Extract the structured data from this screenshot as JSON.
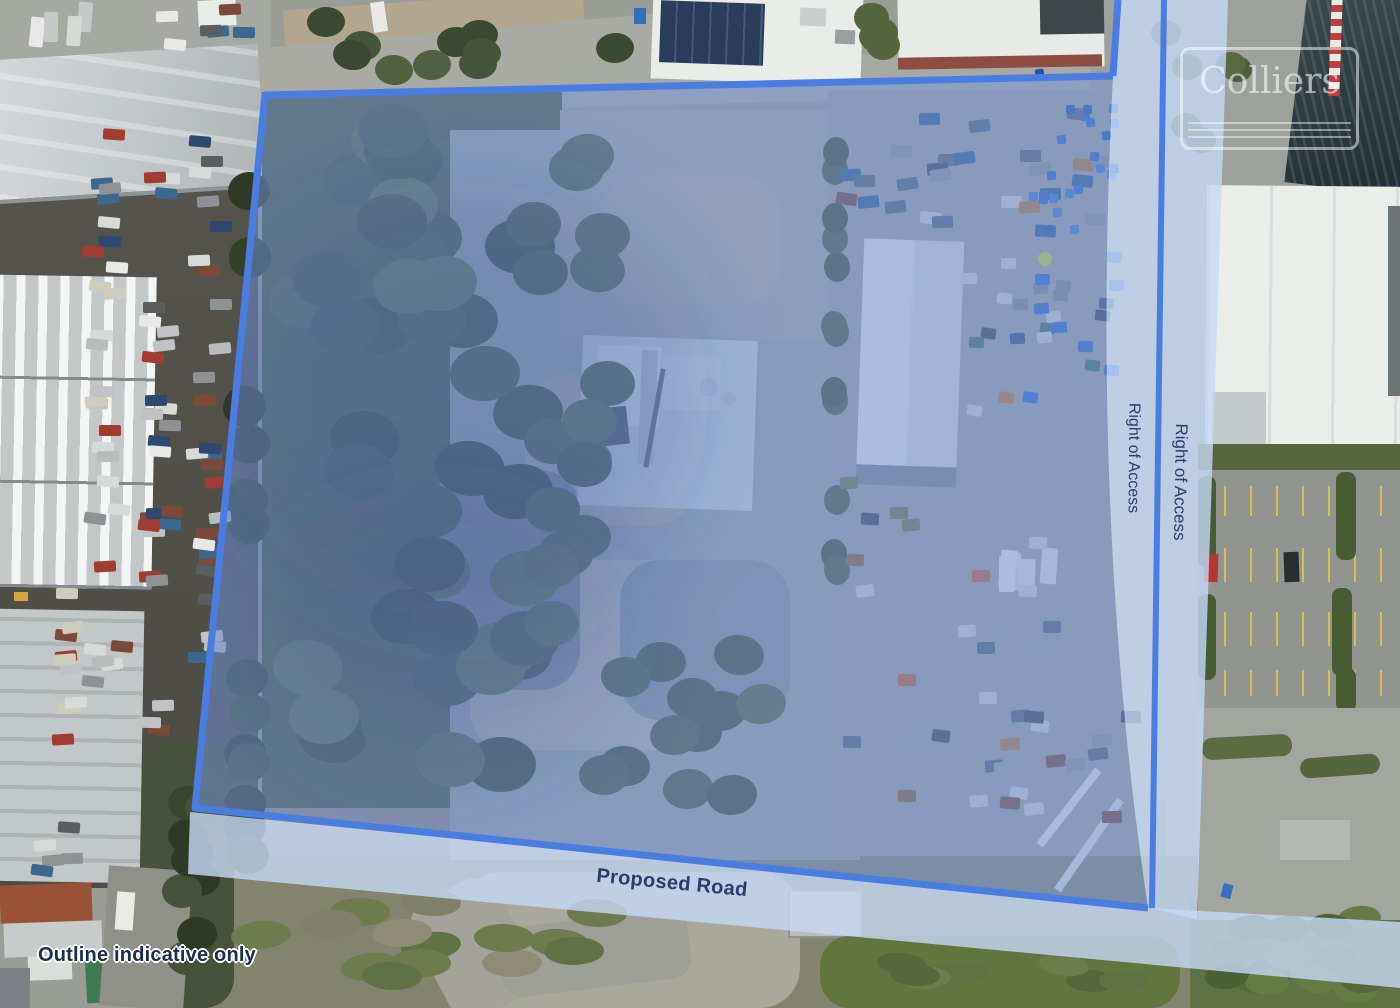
{
  "overlay": {
    "right_of_access_inner": "Right of Access",
    "right_of_access_outer": "Right of Access",
    "proposed_road": "Proposed Road",
    "disclaimer": "Outline indicative only",
    "brand": "Colliers",
    "colors": {
      "boundary_stroke": "#4a7de2",
      "parcel_fill": "rgba(118,152,218,0.52)",
      "access_band_fill": "rgba(198,218,246,0.8)",
      "label_text": "#2a3e6b",
      "disclaimer_text": "#1c2b50",
      "watermark_white": "rgba(255,255,255,0.58)"
    }
  }
}
